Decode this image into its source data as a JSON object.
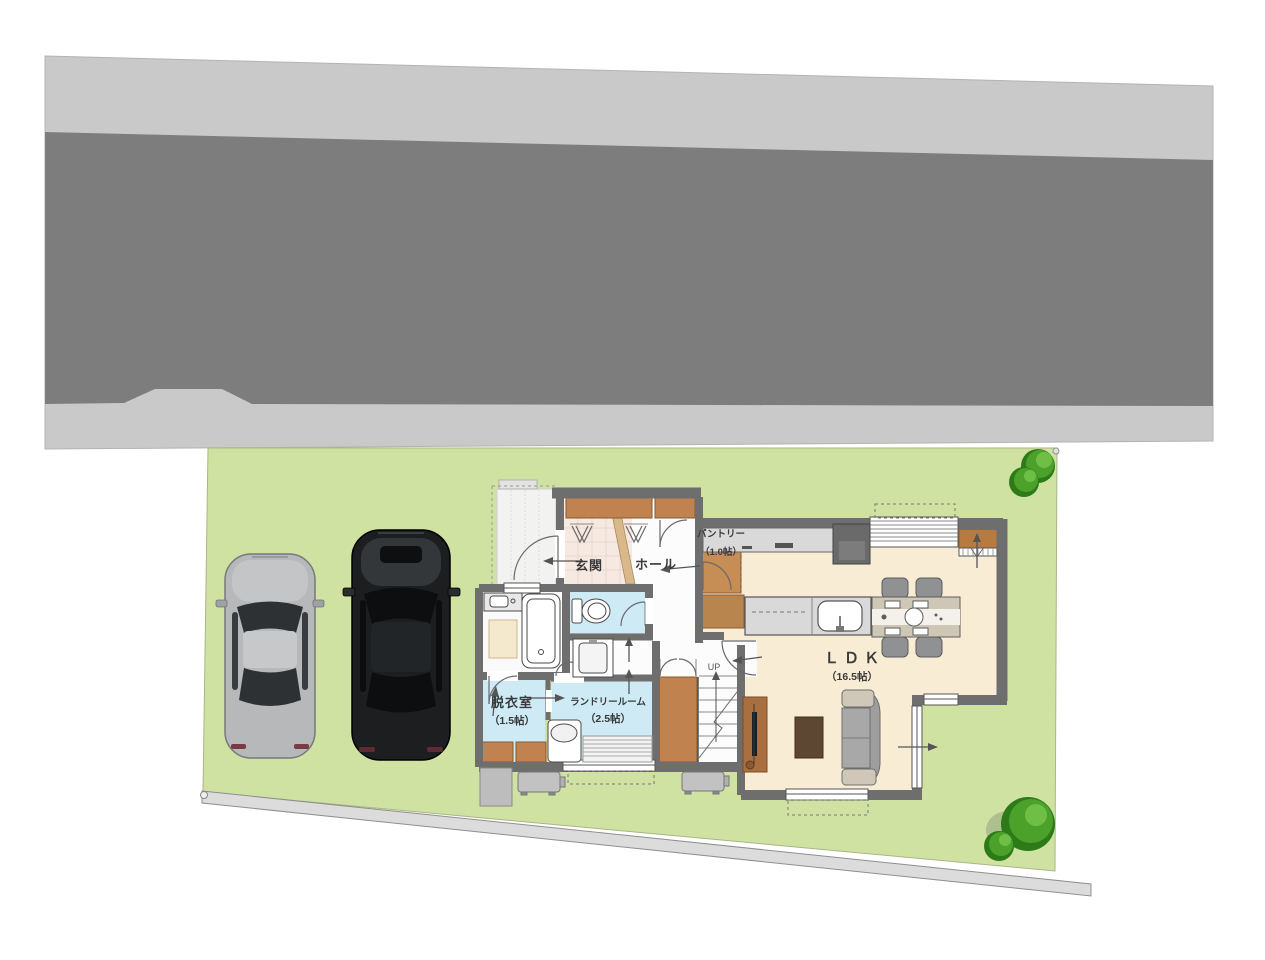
{
  "floor_plan": {
    "rooms": {
      "genkan": {
        "label": "玄関"
      },
      "hall": {
        "label": "ホール"
      },
      "pantry": {
        "label": "パントリー",
        "size": "（1.0帖）"
      },
      "ldk": {
        "label": "ＬＤＫ",
        "size": "（16.5帖）"
      },
      "dressing_room": {
        "label": "脱衣室",
        "size": "（1.5帖）"
      },
      "laundry_room": {
        "label": "ランドリールーム",
        "size": "（2.5帖）"
      }
    },
    "stairs": {
      "up_label": "UP"
    }
  },
  "colors": {
    "road": "#7d7d7d",
    "sidewalk": "#c9c9c9",
    "lawn": "#cfe2a2",
    "wall": "#6e6e6e",
    "ldk_floor": "#f9ecd4",
    "wet_area_floor": "#cdeaf5",
    "entrance_tile": "#f6e9e1",
    "wood_closet": "#c0834f",
    "tree_green": "#4ca12b",
    "car_silver": "#b6b8ba",
    "car_black": "#1c1e20"
  }
}
